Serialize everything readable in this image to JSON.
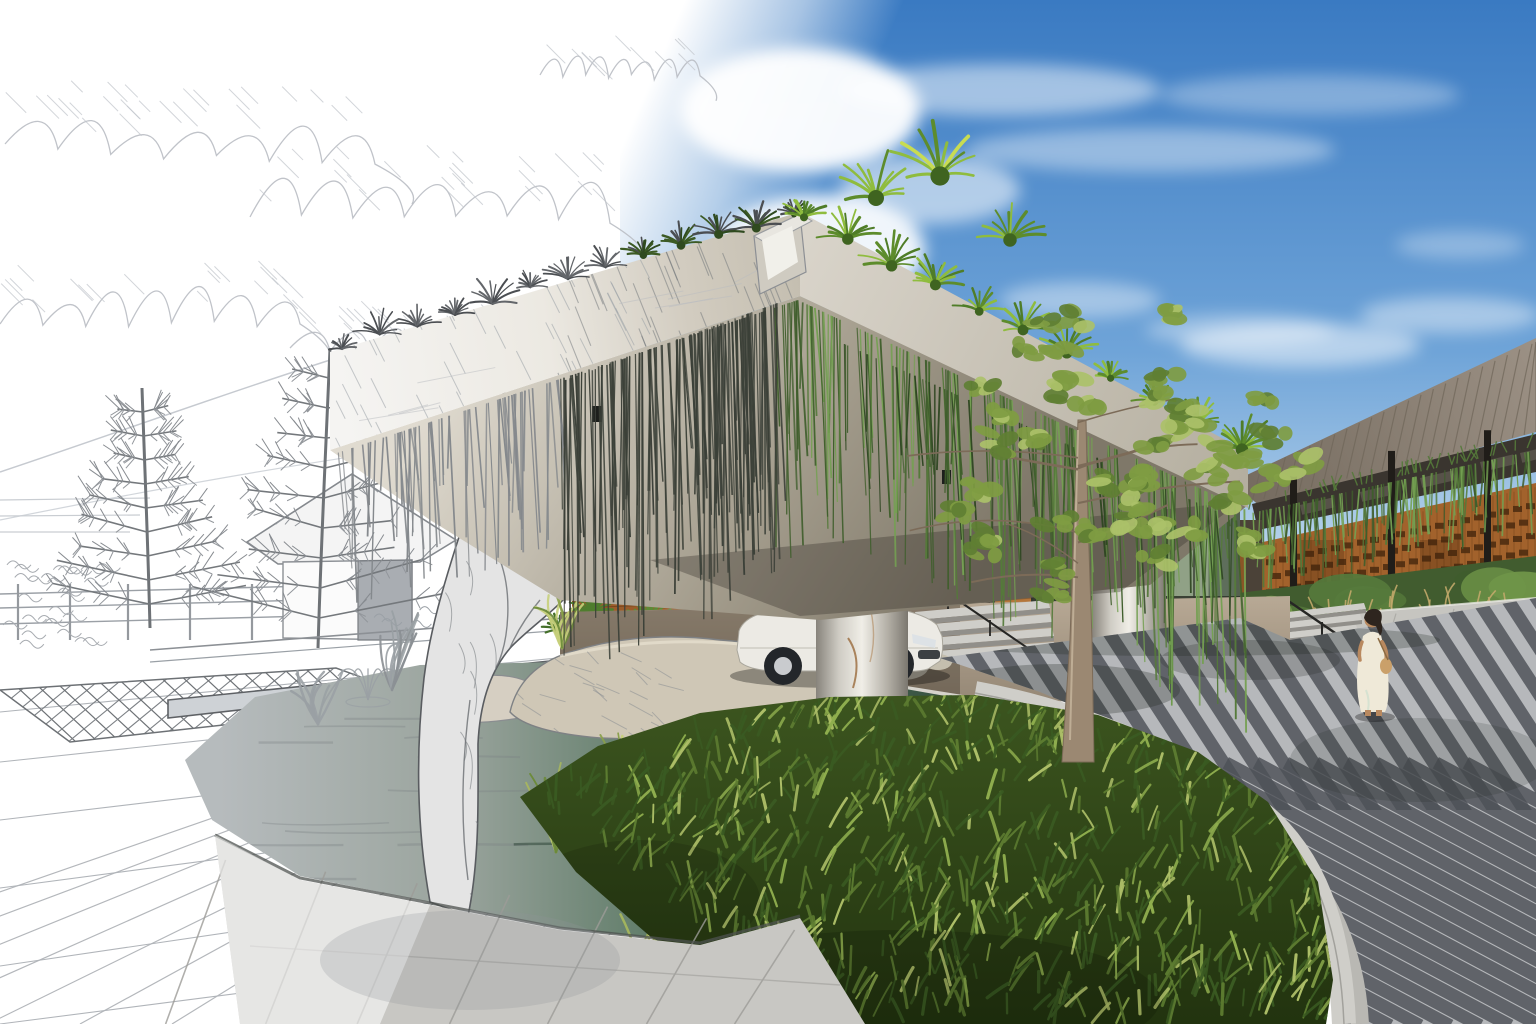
{
  "meta": {
    "artwork_label": "Sketch-to-render architectural visualization of a resort drop-off entrance",
    "left_style": "pencil sketch on white paper",
    "right_style": "photorealistic render"
  },
  "objects": {
    "sky": "blue sky with clouds",
    "clouds_sketch": "pencil-hatched clouds",
    "canopy": "cantilevered green-roof entrance canopy",
    "hanging_vines": "curtain of hanging vines",
    "roof_plants": "spiky agave and yucca planting on canopy roof",
    "column": "round concrete column",
    "car": "white sedan at drop-off",
    "sculpture": "sketched organic stone sculpture",
    "pond": "reflecting pond with fountain",
    "rocks": "boulders at pond edge",
    "grass_bed": "dense ornamental grass bed",
    "tree": "young feathery tree",
    "road": "curved striped paver driveway",
    "curb": "granite curb with trench drain",
    "building": "timber-screen building with metal roof",
    "woman": "woman in a white dress",
    "gazebo_sketch": "sketched hip-roof pavilion",
    "pine_trees_sketch": "sketched pine trees",
    "steps": "entry steps with handrail",
    "planting_bed": "shrub and grass planting bed"
  },
  "palette": {
    "paper": "#ffffff",
    "sky_top": "#3a7ac2",
    "sky_mid": "#6fa4d8",
    "sky_horizon": "#d6e7f3",
    "cloud": "#ffffff",
    "sketch_line": "#9ba0a6",
    "sketch_mid": "#6e7276",
    "sketch_dark": "#4b4e52",
    "hatch": "#9aa0a6",
    "fascia_light": "#f5f4f2",
    "fascia_tan": "#c4beb0",
    "fascia_right_1": "#d9d4ca",
    "fascia_right_2": "#b4ae9f",
    "soffit_light": "#e0dbd0",
    "soffit_mid": "#a49d8d",
    "soffit_deep": "#7f7869",
    "vine_sketch": "#84888c",
    "vine_ink": "#3b4038",
    "vine_green_dark": "#3f5e2c",
    "vine_green": "#557a3a",
    "vine_green_light": "#74a052",
    "plant_green": "#5d8c2c",
    "plant_green_light": "#8fbc3e",
    "column_edge": "#87837b",
    "column_mid": "#cfccc4",
    "column_light": "#f0eee7",
    "rust": "#9a6a3c",
    "glass_stripes": [
      "#5f6f5c",
      "#76886e",
      "#93a489",
      "#4a5846",
      "#66785f"
    ],
    "interior_dark": "#262a23",
    "corten": "#9a5c2a",
    "corten_line": "#6f3f18",
    "wood_warm": "#b5763a",
    "door_dark": "#1f1c18",
    "drive_light": "#b8a995",
    "drive_dark": "#8a7d6c",
    "drive_shadow": "rgba(58,50,40,0.38)",
    "granite_edge": "#d6d3cc",
    "car_body": "#eceae4",
    "car_shade": "#c9c6bd",
    "car_window": "#3f4a52",
    "tire": "#23262a",
    "rim": "#c9cbce",
    "water_sketch": "#b6bbbd",
    "water_mid": "#5d7a66",
    "water_deep": "#35503f",
    "ripple_light": "#d8e4d4",
    "ripple_dark": "#1d3528",
    "stone": "#cfc7b6",
    "stone2": "#d6cfc2",
    "rock_line": "#7e8184",
    "sculpture_fill": "#e4e4e4",
    "sculpture_line": "#595c60",
    "grass_base_top": "#3c551f",
    "grass_base_bot": "#22330f",
    "grass_dark": "#3a5a22",
    "grass_mid": "#5d7c31",
    "grass_light": "#8fae4e",
    "grass_xlight": "#aebf68",
    "tuft_colors": [
      "#a9b85c",
      "#8aa04a",
      "#c6cf7a",
      "#6c8a3a"
    ],
    "tuft_gray": "#9aa0a4",
    "road_light": "#b6b8bb",
    "road_dark": "#4d5157",
    "curb_light": "#cfcec9",
    "curb_mid": "#b9b8b3",
    "drain": "#34373b",
    "walk_top": "#c6c5c0",
    "joint": "#a8a7a2",
    "step_light": "#cfcec9",
    "step_riser": "#918f8a",
    "rail": "#262624",
    "roof_light": "#9b9084",
    "roof_dark": "#746a5e",
    "seam": "#6f6659",
    "clerestory": "#3a352f",
    "screen_wood": "#a2622c",
    "screen_line": "#7e4b1e",
    "screen_slot": "#4a2a0f",
    "post": "#201d19",
    "bed_base": "#415c2f",
    "shrub_dark": "#3f5c2d",
    "shrub_mid": "#55793b",
    "shrub_light": "#6f9448",
    "grass_tan": "#c2a96a",
    "tree_trunk": "#9b8872",
    "tree_trunk_line": "#7c6b58",
    "leaf_dark": "#5f7f33",
    "leaf_mid": "#7f9c42",
    "leaf_light": "#abc169",
    "dress": "#efe9d8",
    "skin": "#b9895f",
    "hair": "#2e251f",
    "bag": "#caa06a"
  }
}
